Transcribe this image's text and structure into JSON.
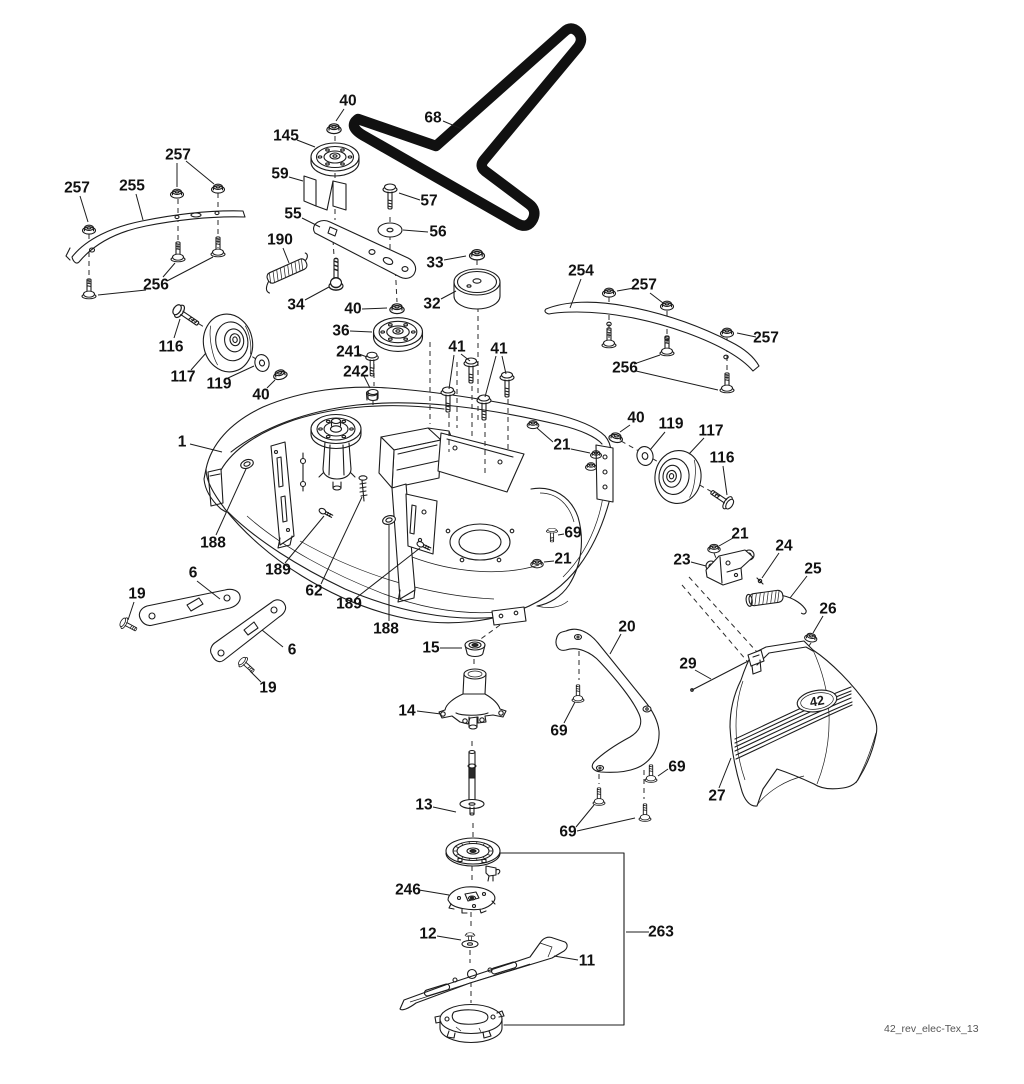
{
  "diagram": {
    "drawing_number": "42_rev_elec-Tex_13",
    "cover_badge": "42",
    "background": "#ffffff",
    "line_color": "#1c1c1c",
    "belt_color": "#111111",
    "callouts": [
      {
        "label": "257",
        "x": 77,
        "y": 188,
        "leaders": [
          [
            80,
            196,
            88,
            222
          ]
        ]
      },
      {
        "label": "255",
        "x": 132,
        "y": 186,
        "leaders": [
          [
            136,
            194,
            143,
            220
          ]
        ]
      },
      {
        "label": "257",
        "x": 178,
        "y": 155,
        "leaders": [
          [
            177,
            163,
            177,
            187
          ],
          [
            186,
            161,
            214,
            184
          ]
        ]
      },
      {
        "label": "256",
        "x": 156,
        "y": 285,
        "leaders": [
          [
            163,
            277,
            175,
            263
          ],
          [
            167,
            281,
            213,
            257
          ],
          [
            146,
            290,
            98,
            295
          ]
        ]
      },
      {
        "label": "116",
        "x": 171,
        "y": 347,
        "leaders": [
          [
            174,
            338,
            180,
            319
          ]
        ]
      },
      {
        "label": "117",
        "x": 183,
        "y": 377,
        "leaders": [
          [
            191,
            370,
            206,
            353
          ]
        ]
      },
      {
        "label": "119",
        "x": 219,
        "y": 384,
        "leaders": [
          [
            228,
            378,
            254,
            366
          ]
        ]
      },
      {
        "label": "40",
        "x": 261,
        "y": 395,
        "leaders": [
          [
            267,
            388,
            275,
            380
          ]
        ]
      },
      {
        "label": "40",
        "x": 348,
        "y": 101,
        "leaders": [
          [
            344,
            109,
            336,
            121
          ]
        ]
      },
      {
        "label": "145",
        "x": 286,
        "y": 136,
        "leaders": [
          [
            297,
            140,
            315,
            147
          ]
        ]
      },
      {
        "label": "68",
        "x": 433,
        "y": 118,
        "leaders": [
          [
            443,
            121,
            462,
            129
          ]
        ]
      },
      {
        "label": "59",
        "x": 280,
        "y": 174,
        "leaders": [
          [
            289,
            177,
            303,
            181
          ]
        ]
      },
      {
        "label": "57",
        "x": 429,
        "y": 201,
        "leaders": [
          [
            420,
            200,
            399,
            193
          ]
        ]
      },
      {
        "label": "55",
        "x": 293,
        "y": 214,
        "leaders": [
          [
            302,
            218,
            320,
            227
          ]
        ]
      },
      {
        "label": "56",
        "x": 438,
        "y": 232,
        "leaders": [
          [
            428,
            232,
            403,
            230
          ]
        ]
      },
      {
        "label": "190",
        "x": 280,
        "y": 240,
        "leaders": [
          [
            283,
            248,
            289,
            263
          ]
        ]
      },
      {
        "label": "33",
        "x": 435,
        "y": 263,
        "leaders": [
          [
            444,
            260,
            466,
            256
          ]
        ]
      },
      {
        "label": "34",
        "x": 296,
        "y": 305,
        "leaders": [
          [
            305,
            300,
            329,
            287
          ]
        ]
      },
      {
        "label": "32",
        "x": 432,
        "y": 304,
        "leaders": [
          [
            441,
            299,
            456,
            291
          ]
        ]
      },
      {
        "label": "40",
        "x": 353,
        "y": 309,
        "leaders": [
          [
            362,
            309,
            387,
            308
          ]
        ]
      },
      {
        "label": "36",
        "x": 341,
        "y": 331,
        "leaders": [
          [
            350,
            331,
            372,
            332
          ]
        ]
      },
      {
        "label": "241",
        "x": 349,
        "y": 352,
        "leaders": [
          [
            359,
            354,
            367,
            357
          ]
        ]
      },
      {
        "label": "242",
        "x": 356,
        "y": 372,
        "leaders": [
          [
            364,
            376,
            370,
            388
          ]
        ]
      },
      {
        "label": "41",
        "x": 457,
        "y": 347,
        "leaders": [
          [
            461,
            354,
            470,
            361
          ],
          [
            454,
            355,
            449,
            389
          ]
        ]
      },
      {
        "label": "41",
        "x": 499,
        "y": 349,
        "leaders": [
          [
            496,
            356,
            485,
            397
          ],
          [
            502,
            356,
            506,
            374
          ]
        ]
      },
      {
        "label": "254",
        "x": 581,
        "y": 271,
        "leaders": [
          [
            581,
            279,
            570,
            308
          ]
        ]
      },
      {
        "label": "257",
        "x": 644,
        "y": 285,
        "leaders": [
          [
            634,
            288,
            617,
            291
          ],
          [
            650,
            293,
            663,
            303
          ]
        ]
      },
      {
        "label": "257",
        "x": 766,
        "y": 338,
        "leaders": [
          [
            756,
            337,
            737,
            333
          ]
        ]
      },
      {
        "label": "256",
        "x": 625,
        "y": 368,
        "leaders": [
          [
            634,
            364,
            660,
            355
          ],
          [
            636,
            371,
            718,
            390
          ]
        ]
      },
      {
        "label": "1",
        "x": 182,
        "y": 442,
        "leaders": [
          [
            190,
            444,
            222,
            452
          ]
        ]
      },
      {
        "label": "188",
        "x": 213,
        "y": 543,
        "leaders": [
          [
            216,
            535,
            246,
            469
          ]
        ]
      },
      {
        "label": "189",
        "x": 278,
        "y": 570,
        "leaders": [
          [
            285,
            563,
            324,
            516
          ]
        ]
      },
      {
        "label": "62",
        "x": 314,
        "y": 591,
        "leaders": [
          [
            321,
            584,
            362,
            497
          ]
        ]
      },
      {
        "label": "189",
        "x": 349,
        "y": 604,
        "leaders": [
          [
            356,
            598,
            420,
            548
          ]
        ]
      },
      {
        "label": "188",
        "x": 386,
        "y": 629,
        "leaders": [
          [
            389,
            621,
            389,
            525
          ]
        ]
      },
      {
        "label": "21",
        "x": 562,
        "y": 445,
        "leaders": [
          [
            553,
            442,
            537,
            428
          ],
          [
            571,
            449,
            590,
            453
          ]
        ]
      },
      {
        "label": "69",
        "x": 573,
        "y": 533,
        "leaders": [
          [
            564,
            534,
            558,
            535
          ]
        ]
      },
      {
        "label": "21",
        "x": 563,
        "y": 559,
        "leaders": [
          [
            554,
            561,
            544,
            562
          ]
        ]
      },
      {
        "label": "40",
        "x": 636,
        "y": 418,
        "leaders": [
          [
            630,
            425,
            620,
            432
          ]
        ]
      },
      {
        "label": "119",
        "x": 671,
        "y": 424,
        "leaders": [
          [
            665,
            432,
            650,
            450
          ]
        ]
      },
      {
        "label": "117",
        "x": 711,
        "y": 431,
        "leaders": [
          [
            704,
            438,
            689,
            454
          ]
        ]
      },
      {
        "label": "116",
        "x": 722,
        "y": 458,
        "leaders": [
          [
            723,
            466,
            727,
            495
          ]
        ]
      },
      {
        "label": "6",
        "x": 193,
        "y": 573,
        "leaders": [
          [
            197,
            581,
            220,
            599
          ]
        ]
      },
      {
        "label": "19",
        "x": 137,
        "y": 594,
        "leaders": [
          [
            134,
            602,
            128,
            620
          ]
        ]
      },
      {
        "label": "6",
        "x": 292,
        "y": 650,
        "leaders": [
          [
            283,
            647,
            262,
            630
          ]
        ]
      },
      {
        "label": "19",
        "x": 268,
        "y": 688,
        "leaders": [
          [
            261,
            682,
            250,
            671
          ]
        ]
      },
      {
        "label": "15",
        "x": 431,
        "y": 648,
        "leaders": [
          [
            440,
            648,
            462,
            648
          ]
        ]
      },
      {
        "label": "14",
        "x": 407,
        "y": 711,
        "leaders": [
          [
            417,
            711,
            441,
            714
          ]
        ]
      },
      {
        "label": "13",
        "x": 424,
        "y": 805,
        "leaders": [
          [
            433,
            807,
            456,
            812
          ]
        ]
      },
      {
        "label": "246",
        "x": 408,
        "y": 890,
        "leaders": [
          [
            419,
            890,
            449,
            895
          ]
        ]
      },
      {
        "label": "12",
        "x": 428,
        "y": 934,
        "leaders": [
          [
            437,
            936,
            461,
            940
          ]
        ]
      },
      {
        "label": "11",
        "x": 587,
        "y": 961,
        "leaders": [
          [
            578,
            960,
            554,
            956
          ]
        ]
      },
      {
        "label": "263",
        "x": 661,
        "y": 932,
        "leaders": [
          [
            649,
            932,
            626,
            932
          ]
        ]
      },
      {
        "label": "20",
        "x": 627,
        "y": 627,
        "leaders": [
          [
            621,
            634,
            610,
            654
          ]
        ]
      },
      {
        "label": "69",
        "x": 559,
        "y": 731,
        "leaders": [
          [
            564,
            723,
            575,
            702
          ]
        ]
      },
      {
        "label": "69",
        "x": 677,
        "y": 767,
        "leaders": [
          [
            668,
            769,
            658,
            776
          ]
        ]
      },
      {
        "label": "69",
        "x": 568,
        "y": 832,
        "leaders": [
          [
            576,
            827,
            594,
            805
          ],
          [
            577,
            831,
            635,
            818
          ]
        ]
      },
      {
        "label": "21",
        "x": 740,
        "y": 534,
        "leaders": [
          [
            733,
            538,
            719,
            546
          ]
        ]
      },
      {
        "label": "23",
        "x": 682,
        "y": 560,
        "leaders": [
          [
            691,
            562,
            706,
            566
          ]
        ]
      },
      {
        "label": "24",
        "x": 784,
        "y": 546,
        "leaders": [
          [
            779,
            553,
            762,
            578
          ]
        ]
      },
      {
        "label": "25",
        "x": 813,
        "y": 569,
        "leaders": [
          [
            807,
            576,
            790,
            598
          ]
        ]
      },
      {
        "label": "26",
        "x": 828,
        "y": 609,
        "leaders": [
          [
            823,
            616,
            813,
            633
          ]
        ]
      },
      {
        "label": "29",
        "x": 688,
        "y": 664,
        "leaders": [
          [
            695,
            670,
            711,
            679
          ]
        ]
      },
      {
        "label": "27",
        "x": 717,
        "y": 796,
        "leaders": [
          [
            719,
            788,
            731,
            758
          ]
        ]
      }
    ]
  }
}
